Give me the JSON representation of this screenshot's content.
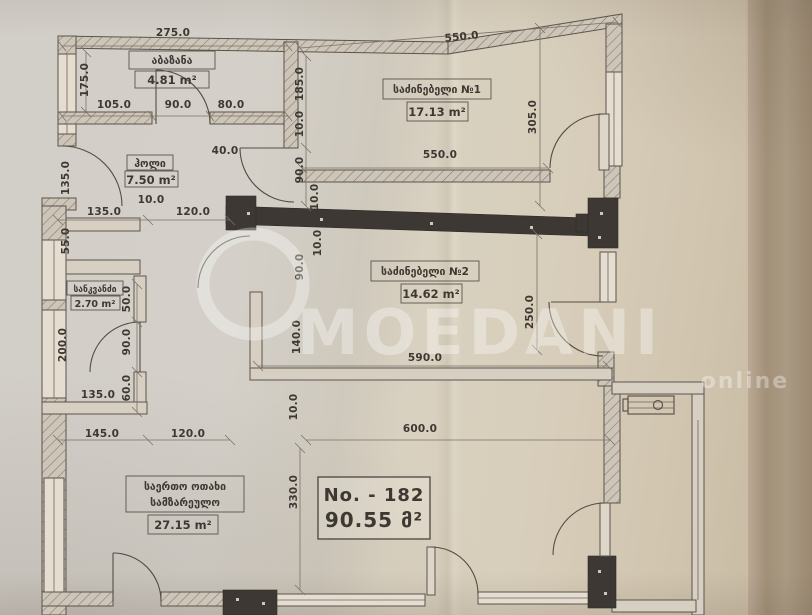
{
  "watermark": {
    "brand": "MOEDANI",
    "subtitle": "online"
  },
  "info_box": {
    "number": "No. - 182",
    "area": "90.55 მ²"
  },
  "rooms": [
    {
      "name": "აბაზანა",
      "area": "4.81 m²"
    },
    {
      "name": "ჰოლი",
      "area": "7.50 m²"
    },
    {
      "name": "საძინებელი №1",
      "area": "17.13 m²"
    },
    {
      "name": "საძინებელი №2",
      "area": "14.62 m²"
    },
    {
      "name": "სანკვანძი",
      "area": "2.70 m²"
    },
    {
      "name_line1": "საერთო ოთახი",
      "name_line2": "სამზარეულო",
      "area": "27.15 m²"
    }
  ],
  "dims": [
    "275.0",
    "175.0",
    "105.0",
    "90.0",
    "80.0",
    "550.0",
    "185.0",
    "10.0",
    "90.0",
    "10.0",
    "10.0",
    "90.0",
    "140.0",
    "10.0",
    "330.0",
    "305.0",
    "550.0",
    "250.0",
    "590.0",
    "600.0",
    "40.0",
    "10.0",
    "135.0",
    "135.0",
    "120.0",
    "55.0",
    "50.0",
    "200.0",
    "90.0",
    "60.0",
    "135.0",
    "145.0",
    "120.0"
  ],
  "colors": {
    "paper": "#d5cdbf",
    "ink": "#4a443d",
    "structure_dark": "#3d3833",
    "watermark": "#ffffff"
  }
}
